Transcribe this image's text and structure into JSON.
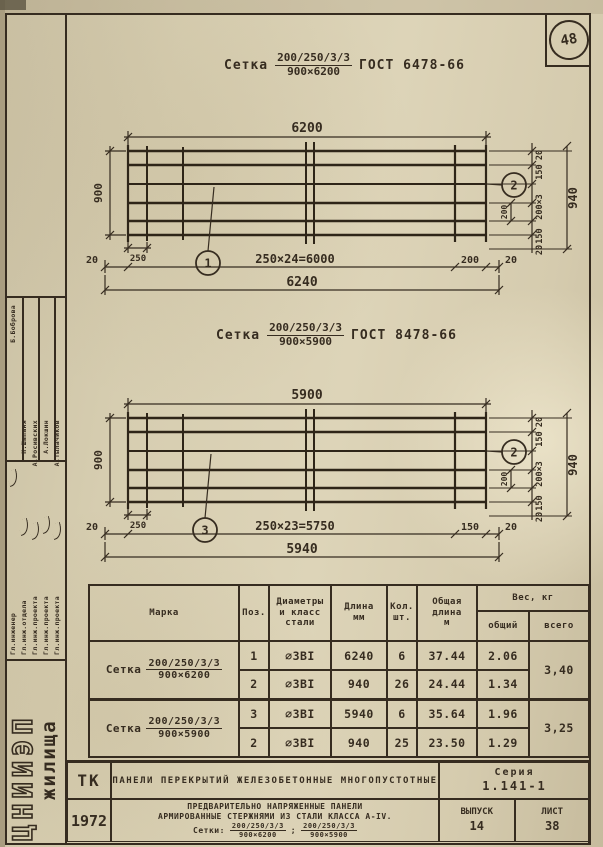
{
  "page_number": "48",
  "titles": {
    "t1": {
      "prefix": "Сетка",
      "num": "200/250/3/3",
      "den": "900×6200",
      "gost": "ГОСТ 6478-66"
    },
    "t2": {
      "prefix": "Сетка",
      "num": "200/250/3/3",
      "den": "900×5900",
      "gost": "ГОСТ 8478-66"
    }
  },
  "d1": {
    "top": "6200",
    "left": "900",
    "end_span": "250",
    "margin_left": "20",
    "spacing": "250×24=6000",
    "end_right": "200",
    "margin_right": "20",
    "total": "6240",
    "right_chain": [
      "20",
      "150",
      "200×3",
      "150",
      "20"
    ],
    "right_total": "940",
    "inner": "200",
    "callout_main": "1",
    "callout_cross": "2"
  },
  "d2": {
    "top": "5900",
    "left": "900",
    "end_span": "250",
    "margin_left": "20",
    "spacing": "250×23=5750",
    "end_right": "150",
    "margin_right": "20",
    "total": "5940",
    "right_chain": [
      "20",
      "150",
      "200×3",
      "150",
      "20"
    ],
    "right_total": "940",
    "inner": "200",
    "callout_main": "3",
    "callout_cross": "2"
  },
  "table": {
    "headers": {
      "mark": "Марка",
      "pos": "Поз.",
      "dia": "Диаметры\nи класс\nстали",
      "len": "Длина\nмм",
      "qty": "Кол.\nшт.",
      "tlen": "Общая\nдлина\nм",
      "weight": "Вес, кг",
      "w_common": "общий",
      "w_total": "всего"
    },
    "groups": [
      {
        "mark_prefix": "Сетка",
        "mark_num": "200/250/3/3",
        "mark_den": "900×6200",
        "total_weight": "3,40",
        "rows": [
          {
            "pos": "1",
            "dia": "∅3ВI",
            "len": "6240",
            "qty": "6",
            "tlen": "37.44",
            "w": "2.06"
          },
          {
            "pos": "2",
            "dia": "∅3ВI",
            "len": "940",
            "qty": "26",
            "tlen": "24.44",
            "w": "1.34"
          }
        ]
      },
      {
        "mark_prefix": "Сетка",
        "mark_num": "200/250/3/3",
        "mark_den": "900×5900",
        "total_weight": "3,25",
        "rows": [
          {
            "pos": "3",
            "dia": "∅3ВI",
            "len": "5940",
            "qty": "6",
            "tlen": "35.64",
            "w": "1.96"
          },
          {
            "pos": "2",
            "dia": "∅3ВI",
            "len": "940",
            "qty": "25",
            "tlen": "23.50",
            "w": "1.29"
          }
        ]
      }
    ]
  },
  "titleblock": {
    "tk": "ТК",
    "year": "1972",
    "row1": "Панели перекрытий железобетонные многопустотные",
    "series_label": "Серия",
    "series_value": "1.141-1",
    "line1": "Предварительно напряженные панели",
    "line2": "армированные стержнями из стали класса А-IV.",
    "nets_label": "Сетки:",
    "net1_num": "200/250/3/3",
    "net1_den": "900×6200",
    "sep": ";",
    "net2_num": "200/250/3/3",
    "net2_den": "900×5900",
    "issue_label": "Выпуск",
    "issue": "14",
    "sheet_label": "Лист",
    "sheet": "38"
  },
  "sidebar": {
    "institute_top": "ЦНИИЭП",
    "institute_bottom": "жилища",
    "rows": [
      {
        "role": "Гл.инженер",
        "name": "Б.Боброва"
      },
      {
        "role": "Гл.инж.отдела",
        "name": "Н.Шапаня"
      },
      {
        "role": "Гл.инж.проекта",
        "name": "А.Росивских"
      },
      {
        "role": "Гл.инж.проекта",
        "name": "А.Локшин"
      },
      {
        "role": "Гл.инж.проекта",
        "name": "А.Тылачиков"
      }
    ]
  }
}
